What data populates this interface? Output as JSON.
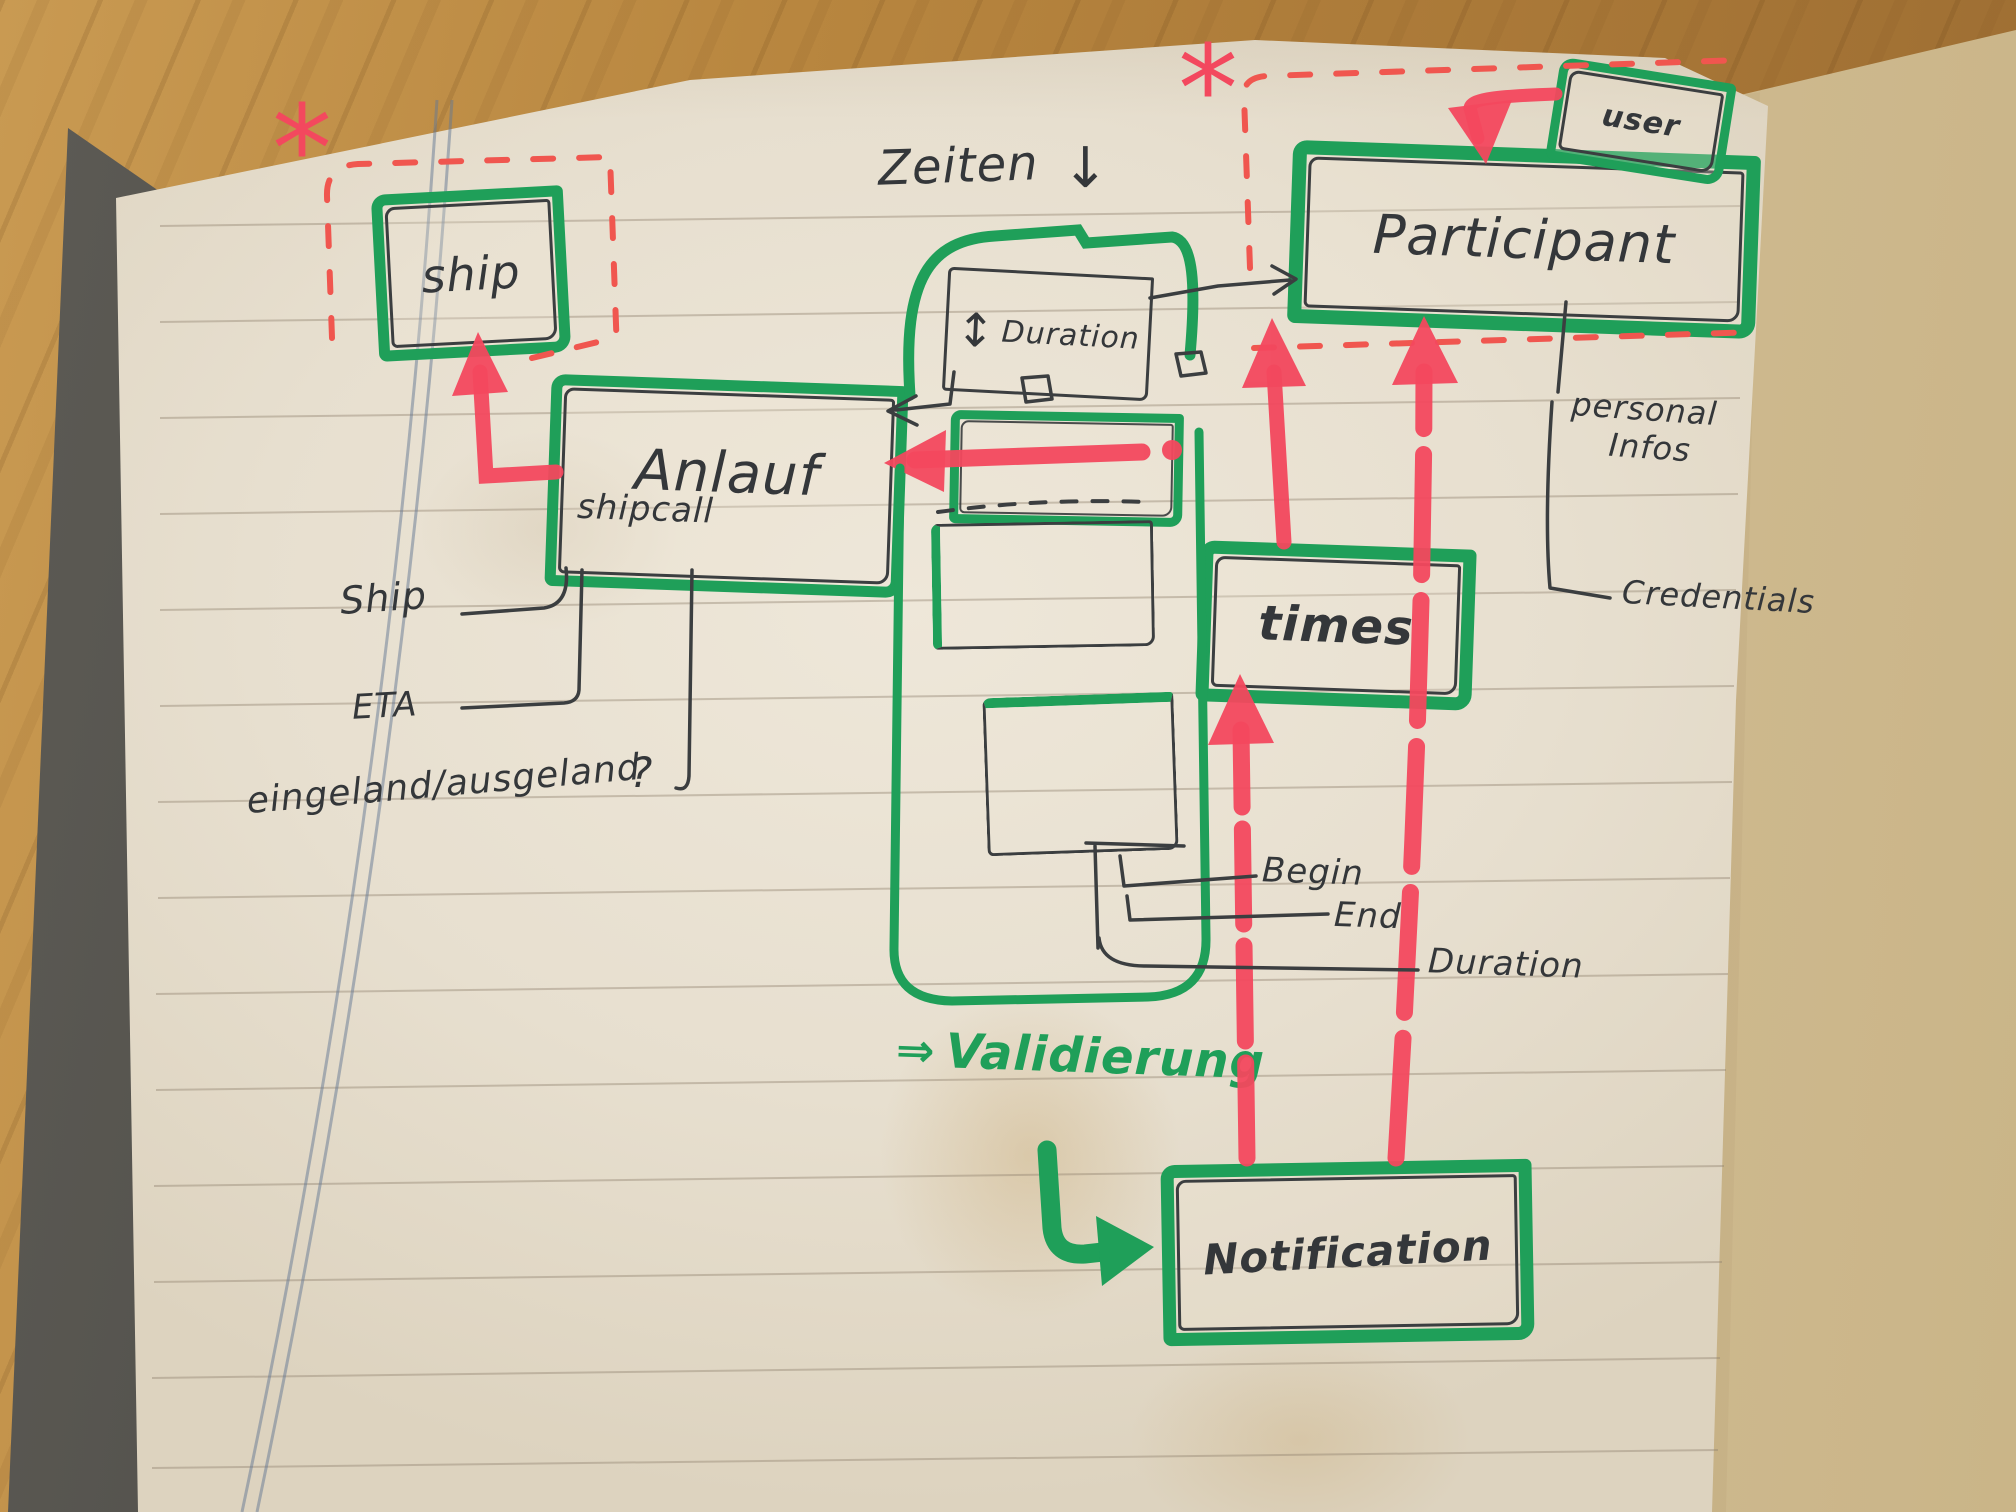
{
  "diagram": {
    "entities": {
      "ship": "ship",
      "anlauf": "Anlauf",
      "anlauf_sub": "shipcall",
      "duration_box_arrow": "↕",
      "duration_box": "Duration",
      "participant": "Participant",
      "user": "user",
      "times": "times",
      "notification": "Notification"
    },
    "labels": {
      "zeiten": "Zeiten",
      "zeiten_arrow": "↓",
      "ship_attr": "Ship",
      "eta": "ETA",
      "ein_aus": "eingeland/ausgeland",
      "question_mark": "?",
      "begin": "Begin",
      "end": "End",
      "duration": "Duration",
      "personal": "personal",
      "infos": "Infos",
      "credentials": "Credentials",
      "validierung_arrow": "⇒",
      "validierung": "Validierung",
      "asterisk": "*"
    },
    "colors": {
      "marker_green": "#1f9f59",
      "marker_red": "#f3485e",
      "pen_black": "#3b3e40"
    }
  }
}
